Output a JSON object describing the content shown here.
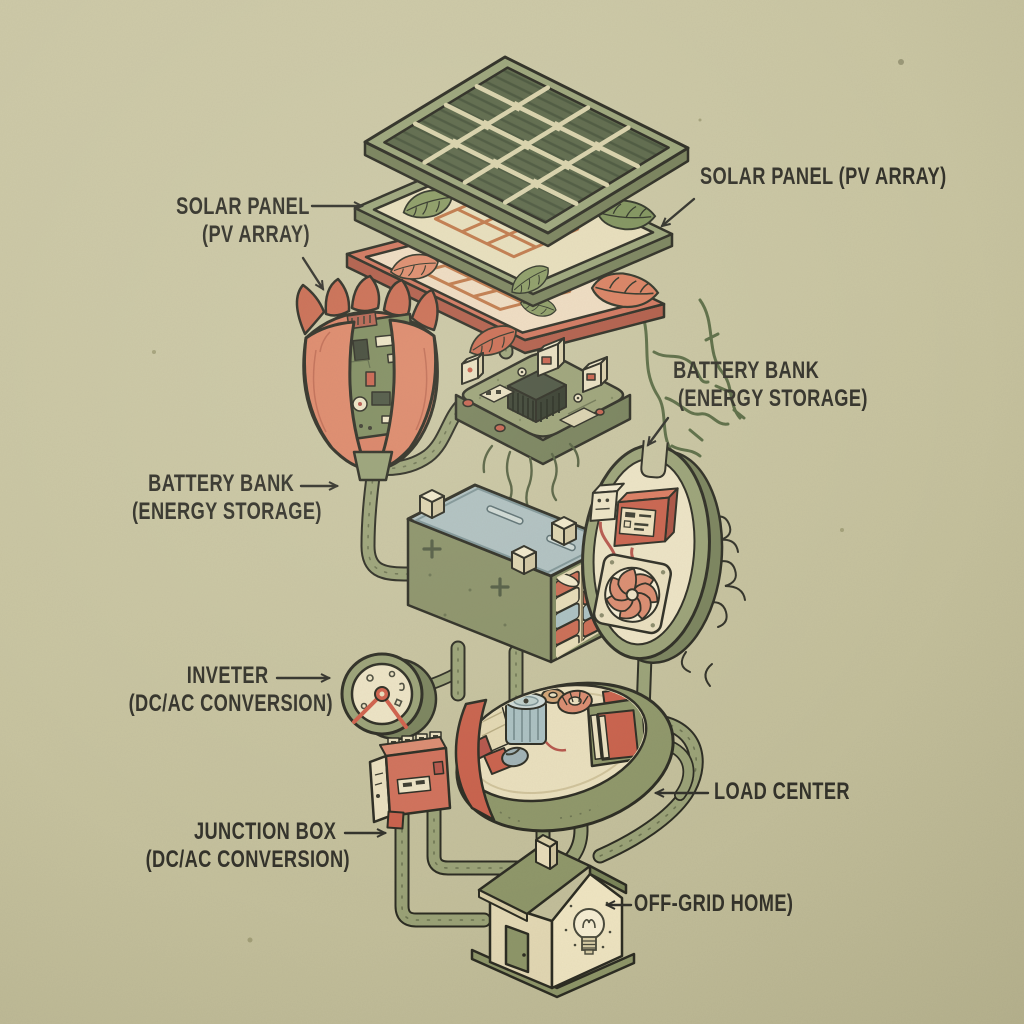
{
  "title": "Off-Grid Solar Power System - illustrated exploded diagram",
  "style_note": "hand-drawn isometric infographic on khaki paper",
  "palette": {
    "background": "#c8c4a1",
    "ink": "#2e2d25",
    "olive": "#99a176",
    "olive_dark": "#77805a",
    "cream": "#e9dfbe",
    "salmon": "#d97f63",
    "red": "#c8604b",
    "blue_gray": "#aebfc0",
    "leaf_green": "#86965f",
    "orange": "#bf7748"
  },
  "labels": {
    "solar_left": {
      "line1": "SOLAR PANEL",
      "line2": "(PV ARRAY)"
    },
    "solar_right": {
      "line1": "SOLAR PANEL (PV ARRAY)"
    },
    "battery_right": {
      "line1": "BATTERY BANK",
      "line2": "(ENERGY STORAGE)"
    },
    "battery_left": {
      "line1": "BATTERY BANK",
      "line2": "(ENERGY STORAGE)"
    },
    "inverter": {
      "line1": "INVETER",
      "line2": "(DC/AC CONVERSION)"
    },
    "junction": {
      "line1": "JUNCTION BOX",
      "line2": "(DC/AC CONVERSION)"
    },
    "load_center": {
      "line1": "LOAD CENTER"
    },
    "home": {
      "line1": "OFF-GRID HOME)"
    }
  },
  "parts": [
    {
      "id": "solar-panel-top",
      "name": "solar panel PV cell layer"
    },
    {
      "id": "leaf-panel-mid",
      "name": "green leaf panel layer"
    },
    {
      "id": "leaf-panel-red",
      "name": "red leaf panel layer with roots"
    },
    {
      "id": "tulip-circuit-flower",
      "name": "tulip flower with circuit board"
    },
    {
      "id": "charge-controller",
      "name": "charge controller circuit pod"
    },
    {
      "id": "battery-box",
      "name": "battery bank box with cells"
    },
    {
      "id": "battery-pod",
      "name": "battery pod with cooling fan"
    },
    {
      "id": "inverter-gauge",
      "name": "inverter gauge dial"
    },
    {
      "id": "load-center-pod",
      "name": "load center pod"
    },
    {
      "id": "junction-box",
      "name": "junction box terminal block"
    },
    {
      "id": "off-grid-home",
      "name": "off-grid home with light bulb"
    },
    {
      "id": "wires",
      "name": "connecting wire tubes"
    }
  ]
}
